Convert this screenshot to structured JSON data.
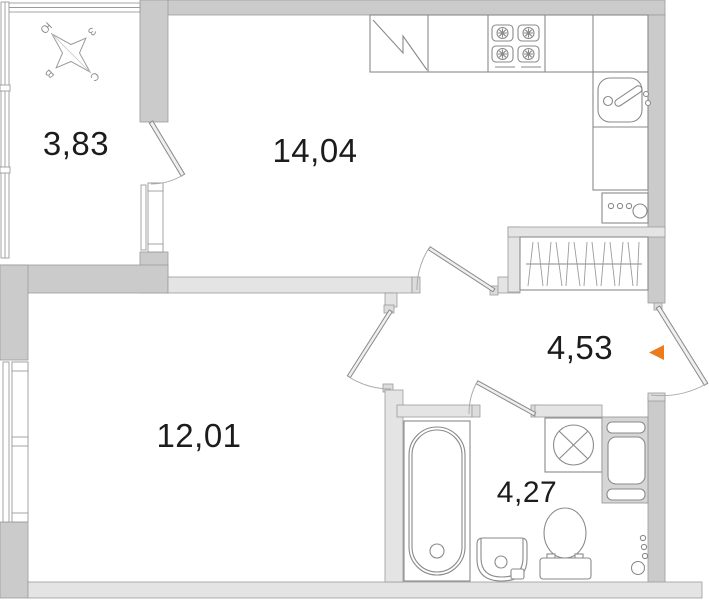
{
  "plan_title": "apartment-floor-plan",
  "colors": {
    "bg": "#ffffff",
    "wall": "#cbcbcb",
    "wall_light": "#e4e4e4",
    "line": "#8a8a8a",
    "thin": "#9b9b9b",
    "text": "#1c1c1c",
    "accent": "#ee7a1e",
    "compass": "#8f8f8f"
  },
  "rooms": [
    {
      "id": "balcony",
      "area": "3,83"
    },
    {
      "id": "kitchen-living",
      "area": "14,04"
    },
    {
      "id": "bedroom",
      "area": "12,01"
    },
    {
      "id": "hallway",
      "area": "4,53"
    },
    {
      "id": "bathroom",
      "area": "4,27"
    }
  ],
  "compass": {
    "north": "С",
    "south": "Ю",
    "east": "В",
    "west": "З"
  },
  "icons": [
    "compass-rose-icon",
    "fridge-icon",
    "stove-icon",
    "kitchen-sink-icon",
    "wardrobe-icon",
    "bathtub-icon",
    "washing-machine-icon",
    "toilet-icon",
    "washbasin-icon",
    "vent-shaft-icon",
    "riser-pipes-icon",
    "entrance-arrow-icon"
  ]
}
